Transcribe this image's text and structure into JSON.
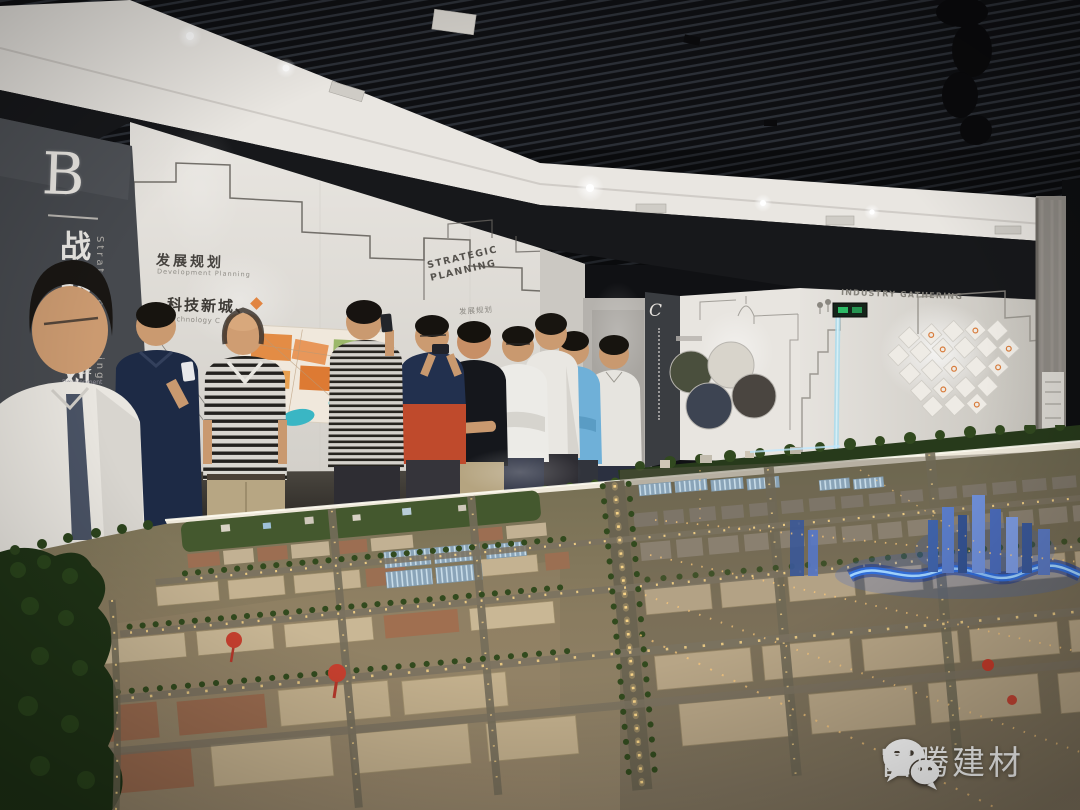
{
  "photo": {
    "type": "exhibition-hall-photograph",
    "caption": "Group of visitors viewing an illuminated city-planning scale model in a planning exhibition hall",
    "people_count": 10
  },
  "panel_b": {
    "letter": "B",
    "title_cn": "战略规划",
    "title_en": "Strategic Planning",
    "items": [
      {
        "cn": "发展",
        "en": "Development"
      },
      {
        "cn": "发展",
        "en": "Development"
      },
      {
        "cn": "发展",
        "en": "Development"
      }
    ]
  },
  "left_wall": {
    "heading_cn": "发展规划",
    "heading_en": "Development Planning",
    "line_cn": "科技新城、",
    "line_en": "Technology C",
    "sign_line1": "STRATEGIC",
    "sign_line2": "PLANNING",
    "sign_sub": "发展规划"
  },
  "c_panel": {
    "letter": "C"
  },
  "right_wall": {
    "heading": "INDUSTRY GATHERING"
  },
  "watermark": {
    "brand": "富腾建材",
    "icon": "wechat-icon"
  },
  "colors": {
    "ceiling": "#101114",
    "soffit_white": "#e9e6e1",
    "upper_band_black": "#17181b",
    "wall_white": "#e2dfda",
    "panel_dark": "#46494e",
    "model_river_blue": "#2f6fe0",
    "model_light_warm": "#ffd98a",
    "map_orange": "#e2873c",
    "watermark_white": "#ffffff"
  },
  "people": [
    {
      "shirt": "white shirt, glasses, foreground"
    },
    {
      "shirt": "navy polo, looking at phone"
    },
    {
      "shirt": "black-white striped polo, khaki trousers, balding"
    },
    {
      "shirt": "striped shirt, phone raised"
    },
    {
      "shirt": "navy and red top, photographing with phone"
    },
    {
      "shirt": "dark navy t-shirt, arms crossed, khaki trousers"
    },
    {
      "shirt": "white shirt, glasses, arms crossed"
    },
    {
      "shirt": "white shirt, tall"
    },
    {
      "shirt": "light blue polo"
    },
    {
      "shirt": "white polo"
    }
  ]
}
